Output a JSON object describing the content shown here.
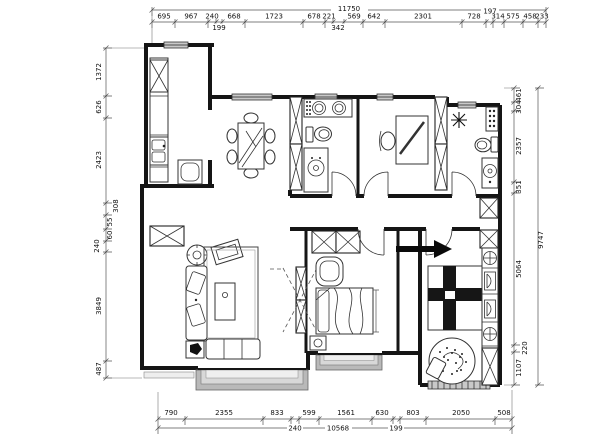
{
  "dims": {
    "top": {
      "total": "11750",
      "segments": [
        "695",
        "967",
        "240",
        "199",
        "668",
        "1723",
        "678",
        "221",
        "342",
        "569",
        "642",
        "2301",
        "728",
        "197",
        "314",
        "575",
        "458",
        "233"
      ]
    },
    "bottom": {
      "total": "10568",
      "segments": [
        "790",
        "2355",
        "833",
        "240",
        "599",
        "1561",
        "630",
        "199",
        "803",
        "2050",
        "508"
      ]
    },
    "left": {
      "segments": [
        "1372",
        "626",
        "2423",
        "308",
        "55",
        "60",
        "240",
        "3849",
        "487"
      ]
    },
    "right": {
      "total": "9747",
      "segments": [
        "461",
        "304",
        "2357",
        "351",
        "5064",
        "220",
        "1107"
      ]
    }
  },
  "colors": {
    "wall": "#151515",
    "window_fill": "#c9c9c9",
    "bay_fill": "#b9b9b9",
    "dim_line": "#555555",
    "ink": "#111111",
    "paper": "#ffffff",
    "dark_fill": "#161616"
  },
  "symbols": {
    "shower_star": "✳",
    "entry_arrow": "➤"
  }
}
